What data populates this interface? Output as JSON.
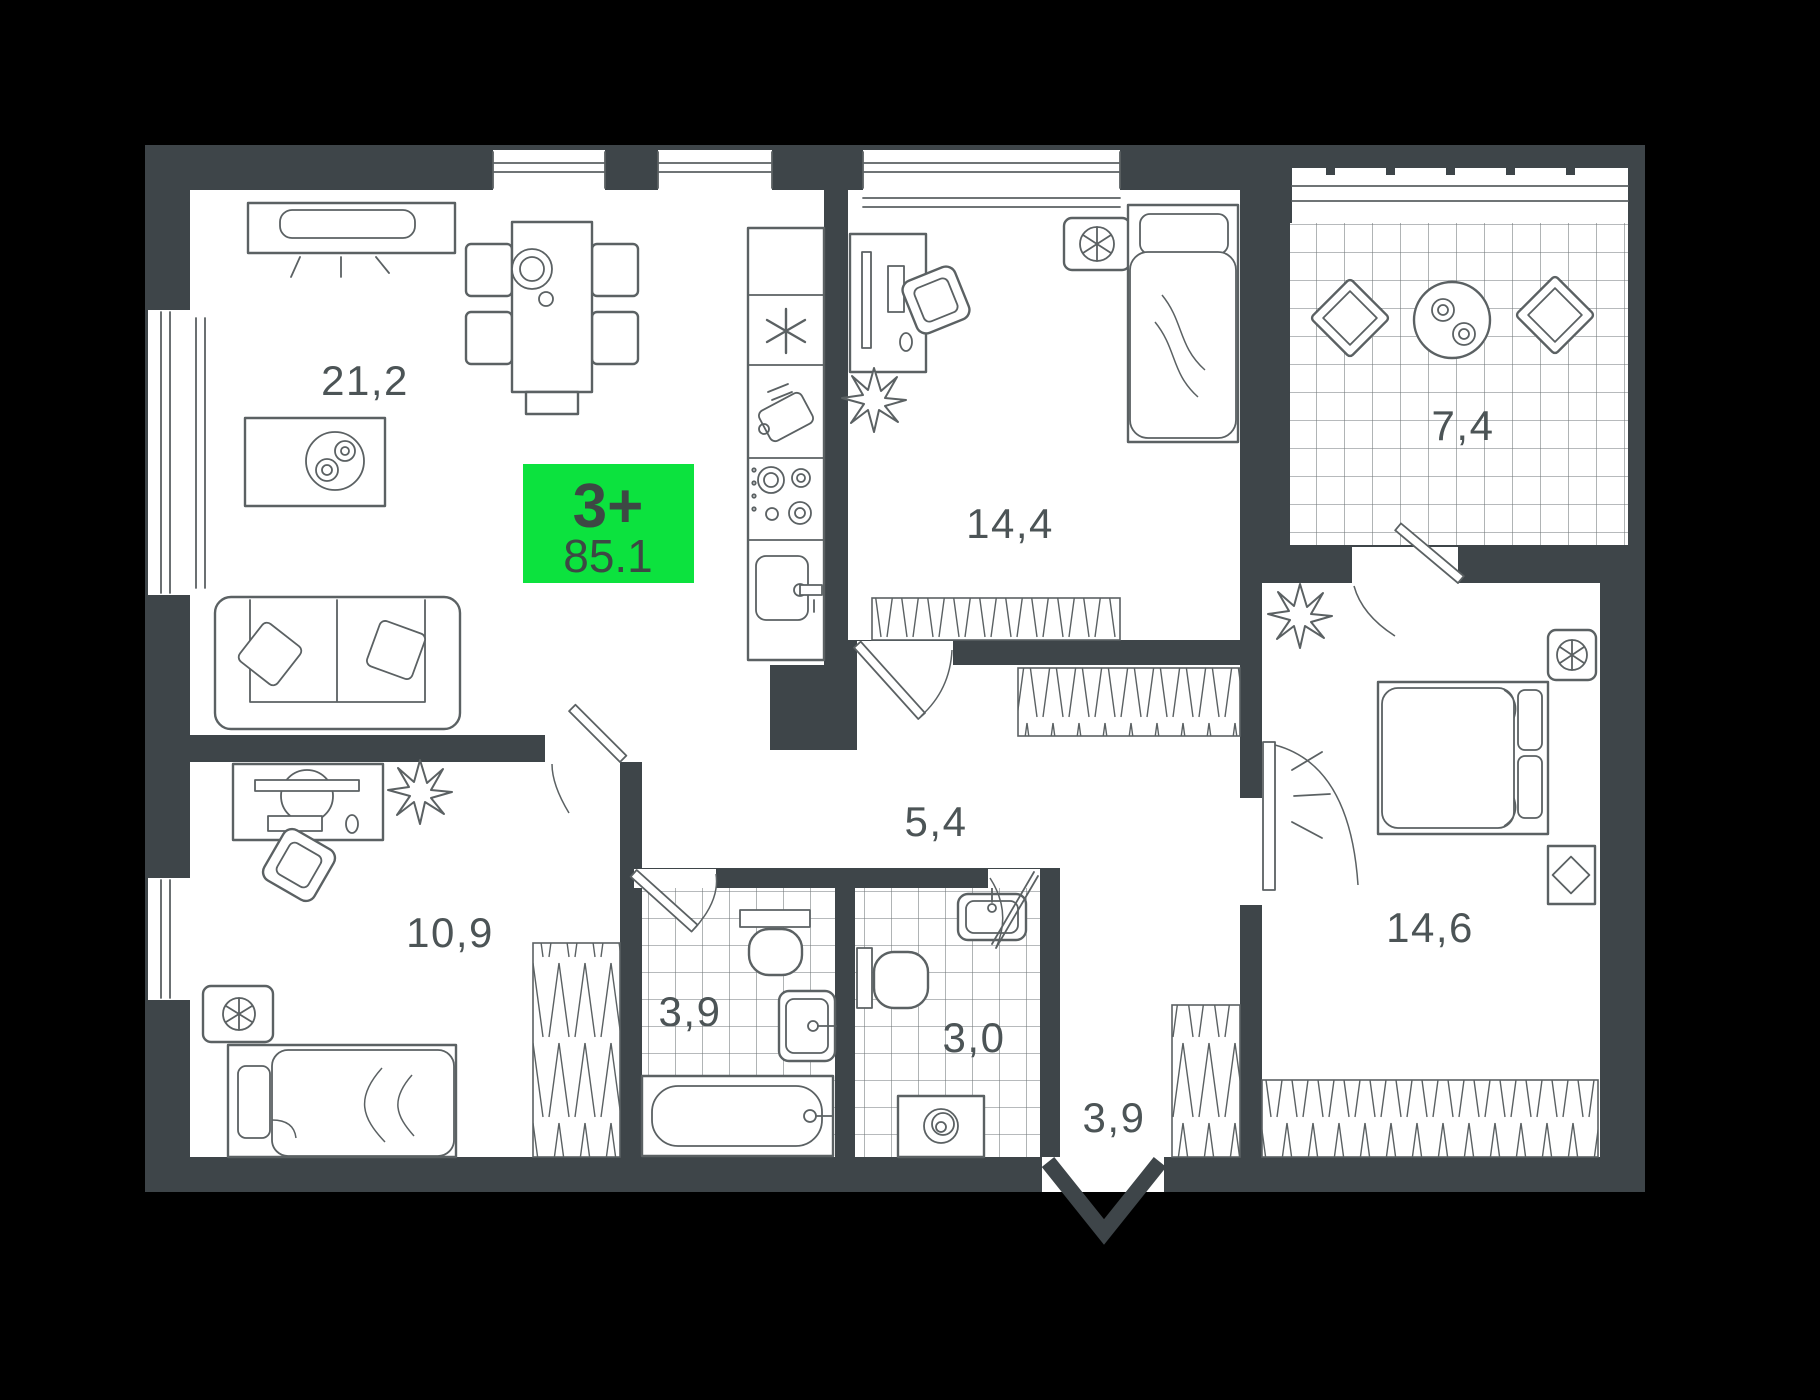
{
  "plan": {
    "badge": {
      "type": "3+",
      "area": "85.1"
    },
    "rooms": {
      "living": {
        "label": "21,2"
      },
      "bedroom2": {
        "label": "14,4"
      },
      "balcony": {
        "label": "7,4"
      },
      "hallway": {
        "label": "5,4"
      },
      "kidsroom": {
        "label": "10,9"
      },
      "bathroom": {
        "label": "3,9"
      },
      "wc": {
        "label": "3,0"
      },
      "entrance": {
        "label": "3,9"
      },
      "bedroom": {
        "label": "14,6"
      }
    },
    "colors": {
      "background": "#000000",
      "wall": "#3E4549",
      "floor": "#ffffff",
      "line": "#5b6163",
      "label": "#4c5456",
      "accent": "#0ce23e",
      "badge_text": "#3d4844"
    }
  }
}
